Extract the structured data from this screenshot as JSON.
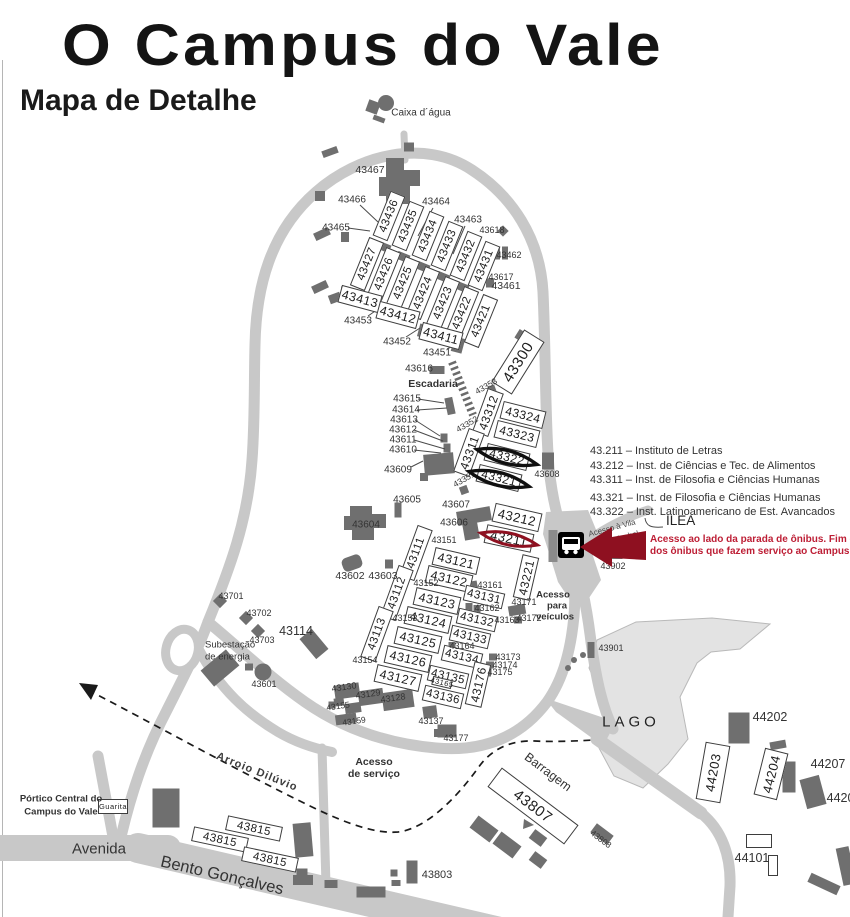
{
  "title": "O Campus do Vale",
  "subtitle": "Mapa de Detalhe",
  "colors": {
    "road": "#c8c8c8",
    "building": "#6f6f6f",
    "lake": "#e3e3e3",
    "accent": "#8e1020",
    "note": "#bd1e35"
  },
  "legend": {
    "items": [
      "43.211 – Instituto de Letras",
      "43.212 – Inst. de Ciências e Tec. de Alimentos",
      "43.311 – Inst. de Filosofia e Ciências Humanas",
      "43.321 – Inst. de Filosofia e Ciências Humanas",
      "43.322 – Inst. Latinoamericano de Est. Avancados"
    ],
    "ilea": "ILEA"
  },
  "note": {
    "line1": "Acesso ao lado da parada de ônibus. Fim da linha",
    "line2": "dos ônibus que fazem serviço ao Campus do Vale"
  },
  "map": {
    "labels": [
      {
        "t": "Caixa d´água",
        "x": 421,
        "y": 113,
        "s": 10
      },
      {
        "t": "43467",
        "x": 370,
        "y": 170,
        "s": 10.5
      },
      {
        "t": "43466",
        "x": 352,
        "y": 200
      },
      {
        "t": "43465",
        "x": 336,
        "y": 228
      },
      {
        "t": "43464",
        "x": 436,
        "y": 202
      },
      {
        "t": "43463",
        "x": 468,
        "y": 220
      },
      {
        "t": "43618",
        "x": 492,
        "y": 230,
        "s": 9
      },
      {
        "t": "43462",
        "x": 509,
        "y": 255,
        "s": 9
      },
      {
        "t": "43617",
        "x": 501,
        "y": 277,
        "s": 9
      },
      {
        "t": "43461",
        "x": 506,
        "y": 286,
        "s": 10.5
      },
      {
        "t": "43453",
        "x": 358,
        "y": 321
      },
      {
        "t": "43452",
        "x": 397,
        "y": 342
      },
      {
        "t": "43451",
        "x": 437,
        "y": 353
      },
      {
        "t": "43616",
        "x": 419,
        "y": 369
      },
      {
        "t": "Escadaria",
        "x": 433,
        "y": 384,
        "s": 10.5,
        "b": 1
      },
      {
        "t": "43615",
        "x": 407,
        "y": 399
      },
      {
        "t": "43614",
        "x": 406,
        "y": 410
      },
      {
        "t": "43613",
        "x": 404,
        "y": 420
      },
      {
        "t": "43612",
        "x": 403,
        "y": 430
      },
      {
        "t": "43611",
        "x": 403,
        "y": 440
      },
      {
        "t": "43610",
        "x": 403,
        "y": 450
      },
      {
        "t": "43609",
        "x": 398,
        "y": 470
      },
      {
        "t": "43353",
        "x": 486,
        "y": 386,
        "s": 8.5,
        "r": -30
      },
      {
        "t": "43352",
        "x": 467,
        "y": 424,
        "s": 8.5,
        "r": -30
      },
      {
        "t": "43351",
        "x": 464,
        "y": 479,
        "s": 8.5,
        "r": -30
      },
      {
        "t": "43608",
        "x": 547,
        "y": 474,
        "s": 9
      },
      {
        "t": "43605",
        "x": 407,
        "y": 500
      },
      {
        "t": "43604",
        "x": 366,
        "y": 525
      },
      {
        "t": "43607",
        "x": 456,
        "y": 505
      },
      {
        "t": "43606",
        "x": 454,
        "y": 523
      },
      {
        "t": "43602",
        "x": 350,
        "y": 576,
        "s": 10.5
      },
      {
        "t": "43603",
        "x": 383,
        "y": 576,
        "s": 10.5
      },
      {
        "t": "43151",
        "x": 444,
        "y": 540,
        "s": 9
      },
      {
        "t": "43152",
        "x": 426,
        "y": 583,
        "s": 9
      },
      {
        "t": "43153",
        "x": 405,
        "y": 618,
        "s": 9
      },
      {
        "t": "43154",
        "x": 365,
        "y": 660,
        "s": 9
      },
      {
        "t": "43161",
        "x": 490,
        "y": 585,
        "s": 9
      },
      {
        "t": "43162",
        "x": 487,
        "y": 608,
        "s": 9
      },
      {
        "t": "43163",
        "x": 507,
        "y": 620,
        "s": 9
      },
      {
        "t": "43164",
        "x": 462,
        "y": 646,
        "s": 9
      },
      {
        "t": "43171",
        "x": 524,
        "y": 602,
        "s": 9
      },
      {
        "t": "43172",
        "x": 529,
        "y": 618,
        "s": 9
      },
      {
        "t": "43173",
        "x": 508,
        "y": 657,
        "s": 9
      },
      {
        "t": "43174",
        "x": 505,
        "y": 665,
        "s": 9
      },
      {
        "t": "43175",
        "x": 500,
        "y": 672,
        "s": 9
      },
      {
        "t": "43130",
        "x": 344,
        "y": 687,
        "s": 9,
        "r": -8
      },
      {
        "t": "43129",
        "x": 368,
        "y": 694,
        "s": 9,
        "r": -8
      },
      {
        "t": "43128",
        "x": 393,
        "y": 698,
        "s": 9,
        "r": -8
      },
      {
        "t": "43155",
        "x": 338,
        "y": 706,
        "s": 8.5,
        "r": -8
      },
      {
        "t": "43159",
        "x": 354,
        "y": 721,
        "s": 8.5,
        "r": -8
      },
      {
        "t": "43137",
        "x": 431,
        "y": 721,
        "s": 9
      },
      {
        "t": "43177",
        "x": 456,
        "y": 738,
        "s": 9
      },
      {
        "t": "43701",
        "x": 231,
        "y": 596,
        "s": 9
      },
      {
        "t": "43702",
        "x": 259,
        "y": 613,
        "s": 9
      },
      {
        "t": "43703",
        "x": 262,
        "y": 640,
        "s": 9
      },
      {
        "t": "43114",
        "x": 296,
        "y": 631,
        "s": 12.5
      },
      {
        "t": "Subestação",
        "x": 205,
        "y": 645,
        "s": 9.5,
        "a": "l"
      },
      {
        "t": "de energia",
        "x": 205,
        "y": 657,
        "s": 9.5,
        "a": "l"
      },
      {
        "t": "43601",
        "x": 264,
        "y": 684,
        "s": 9
      },
      {
        "t": "Acesso",
        "x": 374,
        "y": 762,
        "s": 10.5,
        "b": 1
      },
      {
        "t": "de serviço",
        "x": 374,
        "y": 774,
        "s": 10.5,
        "b": 1
      },
      {
        "t": "Arroio Dilúvio",
        "x": 257,
        "y": 772,
        "s": 11,
        "r": 22,
        "b": 1,
        "c": "#3d3d3d",
        "ls": 1
      },
      {
        "t": "Barragem",
        "x": 548,
        "y": 772,
        "s": 12.5,
        "r": 37
      },
      {
        "t": "LAGO",
        "x": 631,
        "y": 722,
        "s": 15,
        "ls": 4,
        "c": "#222"
      },
      {
        "t": "43901",
        "x": 611,
        "y": 648,
        "s": 9
      },
      {
        "t": "43902",
        "x": 613,
        "y": 566,
        "s": 9
      },
      {
        "t": "Acesso",
        "x": 553,
        "y": 595,
        "s": 9.5,
        "b": 1
      },
      {
        "t": "para",
        "x": 557,
        "y": 606,
        "s": 9.5,
        "b": 1
      },
      {
        "t": "veículos",
        "x": 555,
        "y": 617,
        "s": 9.5,
        "b": 1
      },
      {
        "t": "Acesso à Vila",
        "x": 612,
        "y": 528,
        "s": 8,
        "r": -15,
        "c": "#4a4a4a"
      },
      {
        "t": "Santa Isabel",
        "x": 617,
        "y": 539,
        "s": 8,
        "r": -15,
        "c": "#4a4a4a"
      },
      {
        "t": "44202",
        "x": 770,
        "y": 717,
        "s": 12.5
      },
      {
        "t": "44207",
        "x": 828,
        "y": 764,
        "s": 12.5
      },
      {
        "t": "44206",
        "x": 844,
        "y": 798,
        "s": 12.5
      },
      {
        "t": "44101",
        "x": 752,
        "y": 858,
        "s": 12.5
      },
      {
        "t": "43803",
        "x": 437,
        "y": 875,
        "s": 11
      },
      {
        "t": "43808",
        "x": 601,
        "y": 839,
        "s": 8.5,
        "r": 37
      },
      {
        "t": "Pórtico Central do",
        "x": 61,
        "y": 799,
        "s": 9.5,
        "b": 1
      },
      {
        "t": "Campus do Vale",
        "x": 61,
        "y": 812,
        "s": 9.5,
        "b": 1
      },
      {
        "t": "Avenida",
        "x": 99,
        "y": 849,
        "s": 15
      },
      {
        "t": "Bento Gonçalves",
        "x": 222,
        "y": 876,
        "s": 16.5,
        "r": 13
      }
    ],
    "boxes": [
      {
        "t": "43436",
        "x": 389,
        "y": 216,
        "w": 48,
        "h": 16,
        "r": -68,
        "fs": 11.5
      },
      {
        "t": "43435",
        "x": 408,
        "y": 226,
        "w": 48,
        "h": 16,
        "r": -68,
        "fs": 11.5
      },
      {
        "t": "43434",
        "x": 428,
        "y": 236,
        "w": 48,
        "h": 16,
        "r": -68,
        "fs": 11.5
      },
      {
        "t": "43433",
        "x": 447,
        "y": 246,
        "w": 48,
        "h": 16,
        "r": -68,
        "fs": 11.5
      },
      {
        "t": "43432",
        "x": 466,
        "y": 256,
        "w": 48,
        "h": 16,
        "r": -68,
        "fs": 11.5
      },
      {
        "t": "43431",
        "x": 484,
        "y": 266,
        "w": 48,
        "h": 16,
        "r": -68,
        "fs": 11.5
      },
      {
        "t": "43427",
        "x": 367,
        "y": 264,
        "w": 52,
        "h": 16,
        "r": -68,
        "fs": 11.5
      },
      {
        "t": "43426",
        "x": 384,
        "y": 274,
        "w": 52,
        "h": 16,
        "r": -68,
        "fs": 11.5
      },
      {
        "t": "43425",
        "x": 403,
        "y": 283,
        "w": 52,
        "h": 16,
        "r": -68,
        "fs": 11.5
      },
      {
        "t": "43424",
        "x": 423,
        "y": 293,
        "w": 52,
        "h": 16,
        "r": -68,
        "fs": 11.5
      },
      {
        "t": "43423",
        "x": 443,
        "y": 303,
        "w": 52,
        "h": 16,
        "r": -68,
        "fs": 11.5
      },
      {
        "t": "43422",
        "x": 462,
        "y": 313,
        "w": 52,
        "h": 16,
        "r": -68,
        "fs": 11.5
      },
      {
        "t": "43421",
        "x": 481,
        "y": 321,
        "w": 52,
        "h": 16,
        "r": -68,
        "fs": 11.5
      },
      {
        "t": "43413",
        "x": 360,
        "y": 299,
        "w": 42,
        "h": 18,
        "r": 15,
        "fs": 12.5
      },
      {
        "t": "43412",
        "x": 398,
        "y": 315,
        "w": 42,
        "h": 18,
        "r": 15,
        "fs": 12.5
      },
      {
        "t": "43411",
        "x": 441,
        "y": 336,
        "w": 42,
        "h": 18,
        "r": 15,
        "fs": 12.5
      },
      {
        "t": "43300",
        "x": 518,
        "y": 362,
        "w": 62,
        "h": 24,
        "r": -58,
        "fs": 15
      },
      {
        "t": "43312",
        "x": 488,
        "y": 412,
        "w": 46,
        "h": 17,
        "r": -70,
        "fs": 12
      },
      {
        "t": "43311",
        "x": 469,
        "y": 452,
        "w": 46,
        "h": 17,
        "r": -70,
        "fs": 12
      },
      {
        "t": "43324",
        "x": 523,
        "y": 415,
        "w": 44,
        "h": 18,
        "r": 14,
        "fs": 12
      },
      {
        "t": "43323",
        "x": 517,
        "y": 434,
        "w": 44,
        "h": 18,
        "r": 14,
        "fs": 12
      },
      {
        "t": "43322",
        "x": 507,
        "y": 457,
        "w": 44,
        "h": 18,
        "r": 14,
        "fs": 12
      },
      {
        "t": "43321",
        "x": 499,
        "y": 478,
        "w": 44,
        "h": 18,
        "r": 14,
        "fs": 12
      },
      {
        "t": "43212",
        "x": 517,
        "y": 517,
        "w": 48,
        "h": 19,
        "r": 13,
        "fs": 13
      },
      {
        "t": "43211",
        "x": 509,
        "y": 538,
        "w": 48,
        "h": 19,
        "r": 12,
        "fs": 13
      },
      {
        "t": "43221",
        "x": 526,
        "y": 577,
        "w": 44,
        "h": 17,
        "r": -77,
        "fs": 12
      },
      {
        "t": "43111",
        "x": 416,
        "y": 553,
        "w": 54,
        "h": 16,
        "r": -70,
        "fs": 11.5
      },
      {
        "t": "43112",
        "x": 397,
        "y": 593,
        "w": 54,
        "h": 16,
        "r": -70,
        "fs": 11.5
      },
      {
        "t": "43113",
        "x": 377,
        "y": 634,
        "w": 54,
        "h": 16,
        "r": -70,
        "fs": 11.5
      },
      {
        "t": "43121",
        "x": 456,
        "y": 561,
        "w": 46,
        "h": 18,
        "r": 13,
        "fs": 12.5
      },
      {
        "t": "43122",
        "x": 449,
        "y": 579,
        "w": 46,
        "h": 18,
        "r": 13,
        "fs": 12.5
      },
      {
        "t": "43123",
        "x": 437,
        "y": 601,
        "w": 46,
        "h": 18,
        "r": 13,
        "fs": 12.5
      },
      {
        "t": "43124",
        "x": 428,
        "y": 620,
        "w": 46,
        "h": 18,
        "r": 13,
        "fs": 12.5
      },
      {
        "t": "43125",
        "x": 418,
        "y": 640,
        "w": 46,
        "h": 18,
        "r": 13,
        "fs": 12.5
      },
      {
        "t": "43126",
        "x": 408,
        "y": 659,
        "w": 46,
        "h": 18,
        "r": 13,
        "fs": 12.5
      },
      {
        "t": "43127",
        "x": 398,
        "y": 678,
        "w": 46,
        "h": 18,
        "r": 13,
        "fs": 12.5
      },
      {
        "t": "43131",
        "x": 484,
        "y": 597,
        "w": 40,
        "h": 16,
        "r": 13,
        "fs": 11.5
      },
      {
        "t": "43132",
        "x": 477,
        "y": 620,
        "w": 40,
        "h": 16,
        "r": 13,
        "fs": 11.5
      },
      {
        "t": "43133",
        "x": 470,
        "y": 637,
        "w": 40,
        "h": 16,
        "r": 13,
        "fs": 11.5
      },
      {
        "t": "43134",
        "x": 462,
        "y": 657,
        "w": 40,
        "h": 16,
        "r": 13,
        "fs": 11.5
      },
      {
        "t": "43135",
        "x": 448,
        "y": 677,
        "w": 40,
        "h": 16,
        "r": 13,
        "fs": 11.5
      },
      {
        "t": "43136",
        "x": 443,
        "y": 697,
        "w": 40,
        "h": 16,
        "r": 13,
        "fs": 11.5
      },
      {
        "t": "43176",
        "x": 478,
        "y": 684,
        "w": 44,
        "h": 17,
        "r": -77,
        "fs": 12
      },
      {
        "t": "43165",
        "x": 442,
        "y": 682,
        "w": 20,
        "h": 9,
        "r": 13,
        "fs": 7.5
      },
      {
        "t": "43807",
        "x": 533,
        "y": 806,
        "w": 96,
        "h": 24,
        "r": 37,
        "fs": 15
      },
      {
        "t": "43815",
        "x": 254,
        "y": 828,
        "w": 56,
        "h": 15,
        "r": 12,
        "fs": 11.5
      },
      {
        "t": "43815",
        "x": 220,
        "y": 839,
        "w": 56,
        "h": 15,
        "r": 12,
        "fs": 11.5
      },
      {
        "t": "43815",
        "x": 270,
        "y": 859,
        "w": 56,
        "h": 15,
        "r": 12,
        "fs": 11.5
      },
      {
        "t": "44203",
        "x": 713,
        "y": 772,
        "w": 58,
        "h": 25,
        "r": -80,
        "fs": 13
      },
      {
        "t": "44204",
        "x": 771,
        "y": 774,
        "w": 48,
        "h": 24,
        "r": -76,
        "fs": 13
      },
      {
        "t": "Guarita",
        "x": 113,
        "y": 806,
        "w": 30,
        "h": 15,
        "r": 0,
        "fs": 7.5
      },
      {
        "t": "",
        "x": 759,
        "y": 841,
        "w": 26,
        "h": 14,
        "r": 0,
        "fs": 10
      },
      {
        "t": "",
        "x": 773,
        "y": 865,
        "w": 10,
        "h": 21,
        "r": 0,
        "fs": 10
      }
    ],
    "bus_stop_icon": "bus-icon",
    "water_tower_icon": "water-tower-icon"
  }
}
